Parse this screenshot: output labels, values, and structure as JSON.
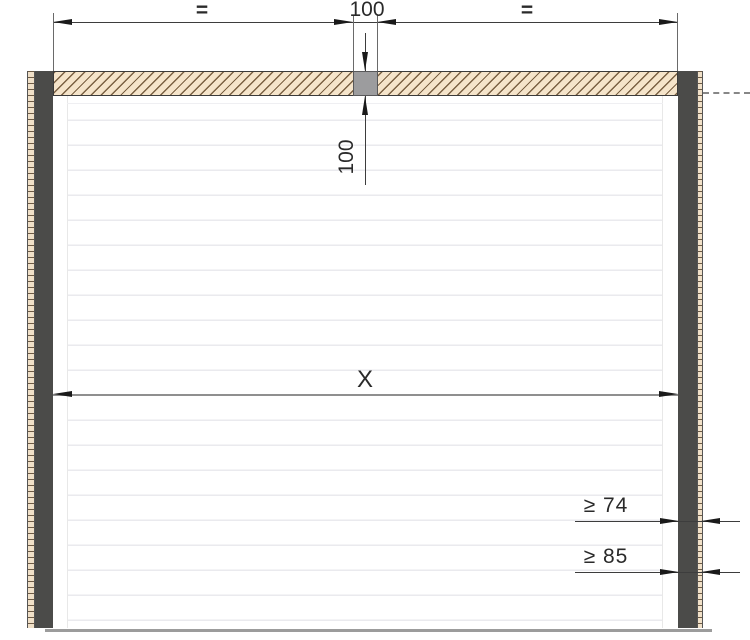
{
  "dimensions": {
    "top_left_equal": "=",
    "block_width": "100",
    "top_right_equal": "=",
    "lintel_height": "100",
    "opening_width": "X",
    "min_side_room_top": "≥ 74",
    "min_side_room_bottom": "≥ 85"
  },
  "colors": {
    "lintel_fill": "#f5e4ca",
    "lintel_hatch": "#7a6042",
    "post_fill": "#4b4b49",
    "center_block_fill": "#9c9c9e",
    "panel_seam": "#eaeaee",
    "floor_line": "#9c9c9c",
    "dimension_line": "#3d3d3d",
    "arrowhead": "#1a1a1a",
    "background": "#ffffff"
  }
}
